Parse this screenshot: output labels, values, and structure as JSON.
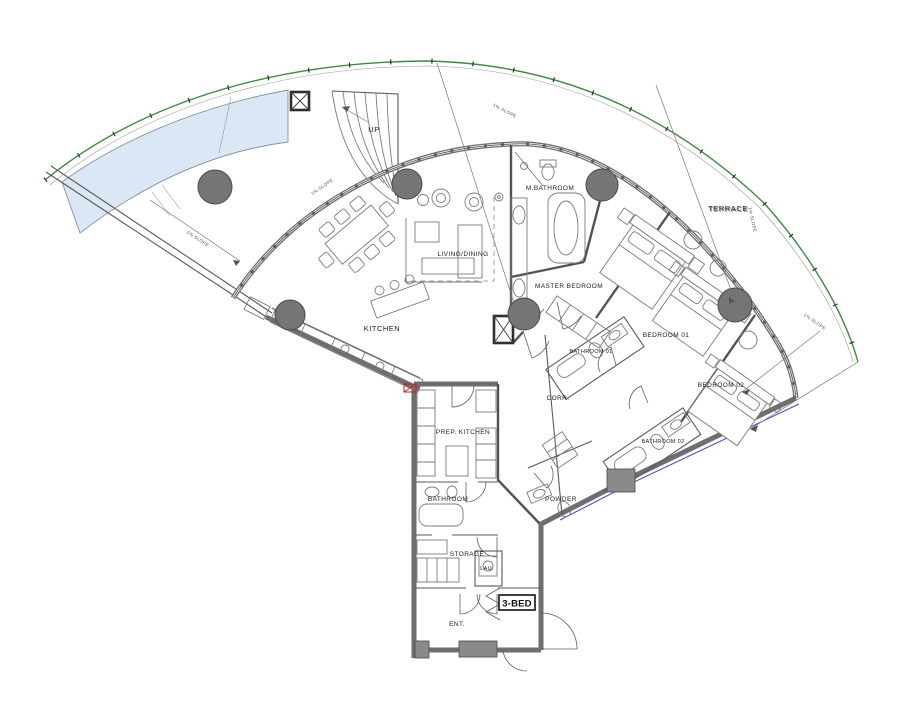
{
  "unit": {
    "badge": "3-BED"
  },
  "rooms": {
    "living_dining": "LIVING/DINING",
    "kitchen": "KITCHEN",
    "m_bathroom": "M.BATHROOM",
    "master_bedroom": "MASTER BEDROOM",
    "bathroom_01": "BATHROOM 01",
    "bedroom_01": "BEDROOM 01",
    "bedroom_02": "BEDROOM 02",
    "bathroom_02": "BATHROOM 02",
    "corridor": "CORR.",
    "powder": "POWDER",
    "prep_kitchen": "PREP. KITCHEN",
    "bathroom": "BATHROOM",
    "storage": "STORAGE",
    "laundry": "LAU.",
    "entrance": "ENT.",
    "terrace": "TERRACE"
  },
  "stairs": {
    "up_label": "UP"
  },
  "annotations": {
    "slope_a": "1% SLOPE",
    "slope_b": "1% SLOPE",
    "slope_c": "1% SLOPE",
    "slope_d": "1% SLOPE",
    "slope_ramp": "1% SLOPE"
  },
  "colors": {
    "boundary_green": "#3d8b40",
    "pool_blue": "#dbe7f5",
    "column_gray": "#757575",
    "wall_gray": "#6e6e6e",
    "accent_red": "#c02020",
    "accent_blue": "#4444cc",
    "paper": "#ffffff"
  }
}
